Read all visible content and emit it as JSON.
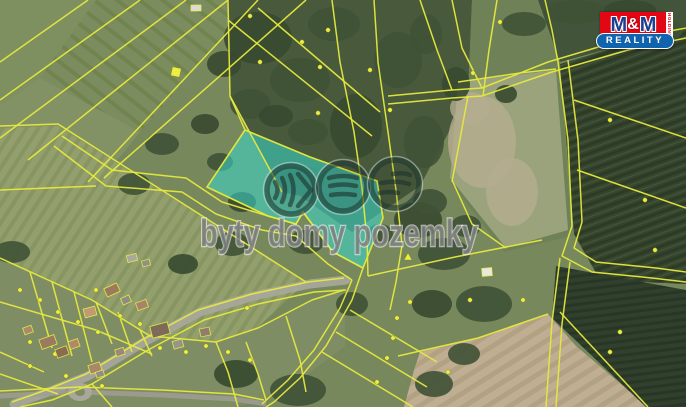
{
  "canvas": {
    "w": 686,
    "h": 407,
    "base": "#77885c"
  },
  "logo": {
    "m1": "M",
    "amp": "&",
    "m2": "M",
    "reality": "REALITY",
    "holding": "HOLDING",
    "red": "#e30613",
    "blue": "#1064ae",
    "navy": "#1c3f93"
  },
  "watermark": {
    "text": "byty domy pozemky",
    "text_fill": "rgba(125,125,125,0.82)",
    "text_stroke": "rgba(248,248,248,0.6)",
    "ring": "rgba(32,55,48,0.58)",
    "rim": "rgba(222,236,229,0.45)",
    "glyph": "rgba(30,52,46,0.62)",
    "icons": [
      {
        "name": "chevrons-icon",
        "cx": 291,
        "cy": 190,
        "paths": [
          "M -16,-8 Q -11,0 -16,8",
          "M -9,-12 Q -3,0 -9,12",
          "M -1,-15 Q 6,0 -1,15",
          "M 7,-16 L 20,0 L 7,16"
        ]
      },
      {
        "name": "bars-icon",
        "cx": 343,
        "cy": 187,
        "paths": [
          "M -14,-9 Q 0,-13 14,-9",
          "M -13,-1 Q 0,-4 13,-1",
          "M -12,8 Q 0,6 12,8"
        ]
      },
      {
        "name": "layers-icon",
        "cx": 395,
        "cy": 184,
        "paths": [
          "M -2,-10 Q 8,-12 15,-9",
          "M -14,-1 Q 2,-4 14,0",
          "M -15,9 Q -6,7 3,9"
        ]
      }
    ]
  },
  "highlight": {
    "points": "245,130 310,157 377,181 383,218 375,238 363,268 333,252 303,212 296,224 268,216 207,187",
    "fill": "rgba(56,218,205,0.55)",
    "stroke": "#e0e63c"
  },
  "map": {
    "line_color": "#e6e93e",
    "tree_fill": "#3f5236",
    "pale_fill": "#b5ad8e",
    "regions": [
      {
        "name": "field-topleft-a",
        "points": "0,0 96,0 40,78 0,106",
        "fill": "#7e8f60"
      },
      {
        "name": "field-topleft-b",
        "points": "96,0 256,0 140,132 40,78",
        "pattern": "tlStripes"
      },
      {
        "name": "field-left-c",
        "points": "0,106 40,78 140,132 96,186 0,192",
        "fill": "#839264"
      },
      {
        "name": "field-left-striped",
        "points": "0,128 58,126 306,282 240,344 148,336 0,258",
        "pattern": "leftStripes"
      },
      {
        "name": "forest-band",
        "points": "228,0 472,0 468,96 420,186 352,232 300,196 282,192 230,96",
        "fill": "#48593c"
      },
      {
        "name": "meadow-topright",
        "points": "472,0 546,0 560,66 572,236 504,252 450,182 468,96",
        "fill": "#6f8257"
      },
      {
        "name": "field-pale-right",
        "points": "458,82 556,70 568,230 506,248 450,178",
        "fill": "#9aa37b"
      },
      {
        "name": "trees-topright-strip",
        "points": "538,0 686,0 686,28 560,62",
        "fill": "#42553a"
      },
      {
        "name": "field-dark-right",
        "points": "560,64 686,26 686,284 600,280 574,234",
        "pattern": "furrowsR"
      },
      {
        "name": "village-area",
        "points": "0,258 92,300 150,336 216,342 258,328 312,300 345,290 345,346 298,382 262,402 232,407 0,407",
        "fill": "#7e8d64"
      },
      {
        "name": "field-tan-bottom",
        "points": "420,352 478,338 548,314 576,346 648,407 404,407 414,370",
        "pattern": "tanStreaks"
      },
      {
        "name": "field-dark-bottomright",
        "points": "556,266 686,290 686,407 646,407 552,318",
        "pattern": "furrowsBR"
      }
    ],
    "pale_patches": [
      [
        482,
        142,
        34,
        46
      ],
      [
        512,
        192,
        26,
        34
      ],
      [
        470,
        108,
        20,
        16
      ]
    ],
    "trees": [
      [
        258,
        38,
        34,
        26
      ],
      [
        300,
        80,
        30,
        22
      ],
      [
        334,
        24,
        26,
        17
      ],
      [
        356,
        126,
        26,
        32
      ],
      [
        303,
        180,
        22,
        14
      ],
      [
        250,
        104,
        20,
        15
      ],
      [
        224,
        64,
        17,
        13
      ],
      [
        398,
        60,
        24,
        28
      ],
      [
        424,
        142,
        20,
        26
      ],
      [
        418,
        220,
        24,
        18
      ],
      [
        444,
        254,
        26,
        16
      ],
      [
        484,
        304,
        28,
        18
      ],
      [
        432,
        304,
        20,
        14
      ],
      [
        306,
        242,
        18,
        12
      ],
      [
        352,
        304,
        16,
        12
      ],
      [
        236,
        374,
        22,
        14
      ],
      [
        298,
        390,
        28,
        16
      ],
      [
        426,
        34,
        16,
        20
      ],
      [
        456,
        84,
        14,
        17
      ],
      [
        524,
        24,
        22,
        12
      ],
      [
        576,
        12,
        32,
        12
      ],
      [
        630,
        10,
        26,
        10
      ],
      [
        668,
        30,
        15,
        10
      ],
      [
        162,
        144,
        17,
        11
      ],
      [
        205,
        124,
        14,
        10
      ],
      [
        134,
        184,
        16,
        11
      ],
      [
        232,
        244,
        17,
        12
      ],
      [
        183,
        264,
        15,
        10
      ],
      [
        434,
        384,
        19,
        13
      ],
      [
        464,
        354,
        16,
        11
      ],
      [
        506,
        94,
        11,
        9
      ],
      [
        380,
        234,
        13,
        10
      ],
      [
        308,
        132,
        20,
        13
      ],
      [
        276,
        116,
        17,
        11
      ],
      [
        430,
        202,
        17,
        13
      ],
      [
        466,
        226,
        15,
        11
      ],
      [
        242,
        202,
        14,
        10
      ],
      [
        220,
        162,
        13,
        9
      ],
      [
        12,
        252,
        18,
        11
      ]
    ],
    "roads": {
      "color": "#a7a79b",
      "track_color": "#9f9e93",
      "main": "14,404 48,392 88,376 144,342 200,312 254,296 310,284 346,280",
      "track": "0,396 80,392 162,395 234,399 266,404",
      "roundabout": [
        80,
        392,
        12,
        9
      ]
    },
    "lines": [
      "0,62 88,0",
      "0,100 140,0",
      "0,138 186,0",
      "28,160 228,0",
      "88,182 258,0",
      "104,178 306,0",
      "0,126 58,124 306,282",
      "0,190 96,186",
      "62,136 112,170 186,178 222,202 268,216 296,224 303,212 333,252 363,268",
      "54,146 106,186 182,192 216,214 262,230 296,236 328,264 352,280",
      "363,268 352,300 326,346 300,378 274,402 266,407",
      "352,280 340,308 314,350 288,380 262,404",
      "228,0 230,96 282,192",
      "230,96 245,130",
      "258,8 380,112",
      "228,20 372,136",
      "332,0 340,62 354,132 362,188 367,240 368,276",
      "374,0 378,62 388,132 396,190 402,245 396,282 390,310",
      "388,96 452,90 482,88",
      "388,104 452,98 482,96",
      "482,88 548,62 622,40 686,28",
      "482,96 552,72 628,50 686,38",
      "452,0 462,48 482,88",
      "497,0 489,50 483,96",
      "420,0 437,50 452,90",
      "545,0 552,30 558,62",
      "558,62 568,140 572,226 562,256 592,272 652,278 686,282",
      "568,60 578,140 582,222 574,248 596,262 656,268 686,272",
      "560,258 552,322 546,407",
      "570,262 562,324 556,407",
      "574,100 686,138",
      "577,170 686,208",
      "368,276 455,257 542,240",
      "350,310 437,362",
      "336,332 427,387",
      "322,352 413,407",
      "398,356 420,351 478,338 548,314",
      "560,312 648,407",
      "0,258 92,300 150,336 216,342 258,328 312,300 344,290",
      "12,402 46,390 86,374 142,340 198,310 252,294 308,282 344,278",
      "20,407 52,400 92,384 148,350 204,320 258,304 314,292 346,290",
      "0,391 80,387 162,390 234,394 264,400",
      "30,272 52,348",
      "52,282 72,356",
      "74,292 92,362",
      "96,302 112,344",
      "118,312 132,352",
      "0,302 96,330 152,354",
      "140,330 152,356",
      "216,342 228,372 238,407",
      "246,342 258,374 266,400",
      "286,316 300,360 306,392",
      "0,352 44,372",
      "0,374 58,394",
      "92,384 112,407",
      "458,82 520,73 556,69",
      "452,180 472,224 506,248",
      "468,96 452,182"
    ],
    "markers": {
      "color": "#ecee46",
      "dots": [
        [
          250,
          16
        ],
        [
          302,
          42
        ],
        [
          328,
          30
        ],
        [
          370,
          70
        ],
        [
          390,
          110
        ],
        [
          260,
          62
        ],
        [
          320,
          67
        ],
        [
          318,
          113
        ],
        [
          247,
          308
        ],
        [
          410,
          302
        ],
        [
          397,
          318
        ],
        [
          393,
          338
        ],
        [
          387,
          358
        ],
        [
          377,
          382
        ],
        [
          473,
          73
        ],
        [
          500,
          22
        ],
        [
          610,
          120
        ],
        [
          645,
          200
        ],
        [
          655,
          250
        ],
        [
          620,
          332
        ],
        [
          470,
          300
        ],
        [
          523,
          300
        ],
        [
          448,
          372
        ],
        [
          610,
          352
        ],
        [
          20,
          290
        ],
        [
          40,
          300
        ],
        [
          58,
          312
        ],
        [
          78,
          322
        ],
        [
          98,
          332
        ],
        [
          30,
          342
        ],
        [
          55,
          354
        ],
        [
          120,
          316
        ],
        [
          140,
          324
        ],
        [
          160,
          348
        ],
        [
          186,
          352
        ],
        [
          206,
          346
        ],
        [
          66,
          376
        ],
        [
          102,
          386
        ],
        [
          30,
          366
        ],
        [
          228,
          352
        ],
        [
          250,
          360
        ],
        [
          96,
          290
        ]
      ],
      "squares": [
        [
          176,
          72
        ]
      ],
      "triangles": [
        [
          408,
          257
        ]
      ]
    },
    "houses": [
      [
        48,
        342,
        16,
        10,
        -20,
        "#9a7b5f"
      ],
      [
        62,
        352,
        12,
        9,
        -20,
        "#8a6a50"
      ],
      [
        74,
        344,
        10,
        8,
        -20,
        "#b08a68"
      ],
      [
        90,
        312,
        12,
        9,
        -15,
        "#c09a72"
      ],
      [
        112,
        290,
        14,
        9,
        -25,
        "#9b7b5c"
      ],
      [
        126,
        300,
        9,
        7,
        -25,
        "#8d8d85"
      ],
      [
        142,
        305,
        11,
        8,
        -20,
        "#a5846a"
      ],
      [
        160,
        330,
        18,
        12,
        -15,
        "#7d6a58"
      ],
      [
        178,
        344,
        10,
        8,
        -15,
        "#96948c"
      ],
      [
        95,
        368,
        12,
        9,
        -18,
        "#a8886a"
      ],
      [
        120,
        352,
        9,
        7,
        -18,
        "#99897b"
      ],
      [
        28,
        330,
        9,
        7,
        -20,
        "#ab8a6c"
      ],
      [
        205,
        332,
        10,
        8,
        -12,
        "#8f7e6e"
      ],
      [
        100,
        374,
        8,
        6,
        -18,
        "#8f8f86"
      ],
      [
        132,
        258,
        10,
        7,
        -15,
        "#a8a89e"
      ],
      [
        146,
        263,
        8,
        6,
        -15,
        "#8f9088"
      ],
      [
        487,
        272,
        10,
        8,
        -5,
        "#e9e9e3"
      ],
      [
        196,
        8,
        10,
        6,
        0,
        "#dcdcd6"
      ]
    ]
  }
}
